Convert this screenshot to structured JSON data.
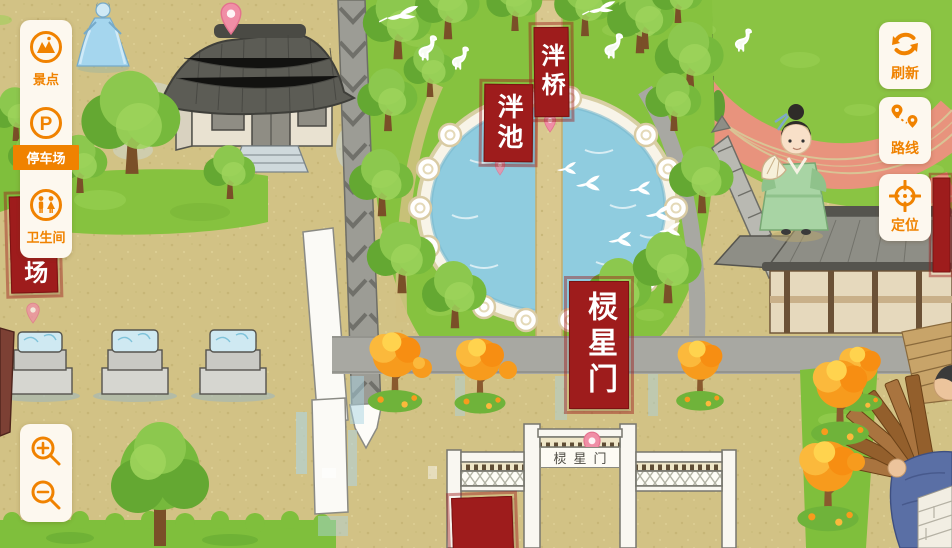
{
  "ui": {
    "accent_color": "#f08200",
    "sidebar": {
      "items": [
        {
          "label": "景点",
          "icon": "scenic-spots-icon",
          "active": false
        },
        {
          "label": "停车场",
          "icon": "parking-icon",
          "active": true
        },
        {
          "label": "卫生间",
          "icon": "restroom-icon",
          "active": false
        }
      ],
      "parking_glyph": "P"
    },
    "zoom_controls": {
      "zoom_in_icon": "magnifier-plus",
      "zoom_out_icon": "magnifier-minus"
    },
    "action_buttons": [
      {
        "label": "刷新",
        "icon": "refresh-icon"
      },
      {
        "label": "路线",
        "icon": "route-icon"
      },
      {
        "label": "定位",
        "icon": "locate-icon"
      }
    ]
  },
  "map": {
    "colors": {
      "ground": "#d2c285",
      "grass": "#86c23f",
      "water": "#8fccdf",
      "banner_red": "#9e1c1c",
      "track": "#e8937d"
    },
    "poi_banners": {
      "pan_pond": "泮池",
      "pan_bridge": "泮桥",
      "lingxing_gate": "棂星门",
      "parking_partial": "场"
    },
    "gate_plaque": "棂星门"
  }
}
